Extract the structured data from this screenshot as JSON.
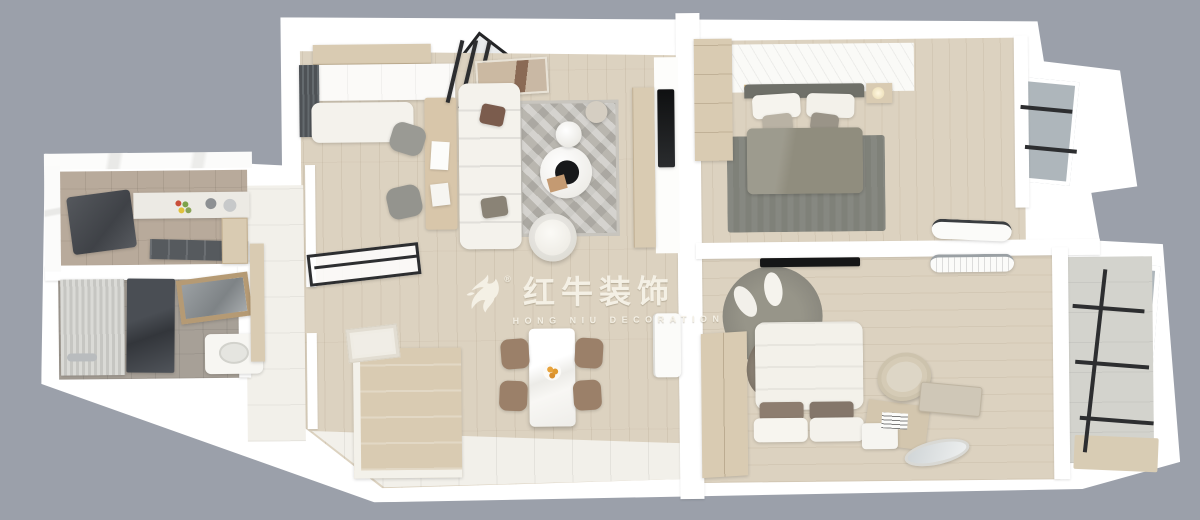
{
  "watermark": {
    "registered_mark": "®",
    "title_cn": "红牛装饰",
    "subtitle_en": "HONG NIU DECORATION"
  },
  "scene": {
    "type": "top-down 3D dollhouse render of an apartment floor plan",
    "rooms": [
      {
        "id": "kitchen",
        "contents": [
          "dark-fridge",
          "counter-with-sink",
          "stove-with-pots",
          "lower-cabinets"
        ]
      },
      {
        "id": "bathroom",
        "contents": [
          "shower-glass",
          "shower-curtain",
          "vanity-mirror",
          "vanity-sink"
        ]
      },
      {
        "id": "hallway",
        "contents": [
          "tile-floor",
          "side-cabinet",
          "drying-rack",
          "relief-art"
        ]
      },
      {
        "id": "entry",
        "contents": [
          "dark-curtain",
          "white-bench",
          "top-cabinets"
        ]
      },
      {
        "id": "living-room",
        "contents": [
          "white-sofa",
          "patterned-rug",
          "round-coffee-tables",
          "armchair",
          "floor-lamp",
          "desk-with-two-chairs",
          "black-glass-partition",
          "wall-art",
          "tv-panel",
          "media-console"
        ]
      },
      {
        "id": "dining-area",
        "contents": [
          "marble-dining-table",
          "four-brown-chairs",
          "fruit-plate",
          "fridge",
          "plant",
          "island-cabinet",
          "white-tile-walkway"
        ]
      },
      {
        "id": "bedroom-primary",
        "contents": [
          "double-bed-olive-duvet",
          "gray-rug",
          "slippers",
          "wardrobe",
          "paneled-headboard-wall",
          "sheer-curtains",
          "bay-window",
          "ac-unit",
          "nightstand-lamp"
        ]
      },
      {
        "id": "bedroom-second",
        "contents": [
          "white-bed",
          "round-gray-rug",
          "white-cushions",
          "wardrobe",
          "wall-tv",
          "basket-chair",
          "storage-box",
          "oval-mirror",
          "nightstand-lamp",
          "plant",
          "ac-unit",
          "sheer-curtains"
        ]
      },
      {
        "id": "balcony",
        "contents": [
          "black-framed-glazing",
          "tile-floor",
          "beige-mat"
        ]
      }
    ]
  },
  "palette": {
    "background": "#9ba0aa",
    "wall": "#ffffff",
    "wood-floor": "#dcd2c0",
    "tile-white": "#f2f0ea",
    "kitchen-tile": "#b8aa9b",
    "bath-tile": "#a7a097",
    "rug-light": "#b9b6af",
    "rug-dark": "#7f8179",
    "sofa-white": "#f4f2ec",
    "cabinet-beige": "#d9cbb2",
    "curtain-taupe": "#c3b8a5",
    "glass-gray": "#aeb6bb",
    "frame-black": "#2d2e30",
    "duvet-olive": "#908d7e",
    "chair-brown": "#9b8069",
    "watermark-cream": "#f6f2e7"
  }
}
